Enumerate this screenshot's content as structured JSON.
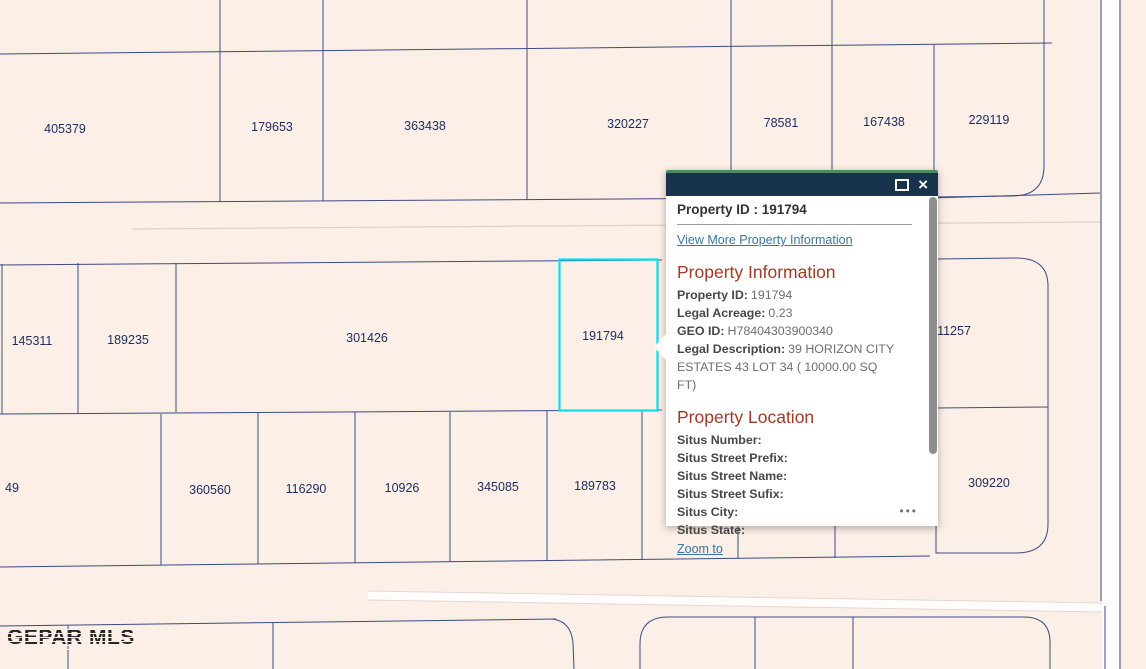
{
  "app": {
    "watermark": "GEPAR MLS"
  },
  "map": {
    "background_color": "#fbefe8",
    "parcel_line_color": "#3d4c80",
    "parcel_label_color": "#1e2c5c",
    "highlight_color": "#06dff1",
    "road_color": "#fffdfb",
    "parcels": [
      "405379",
      "179653",
      "363438",
      "320227",
      "78581",
      "167438",
      "229119",
      "145311",
      "189235",
      "301426",
      "191794",
      "11257",
      "49",
      "360560",
      "116290",
      "10926",
      "345085",
      "189783",
      "309220"
    ],
    "highlighted_parcel": "191794"
  },
  "popup": {
    "title": "Property ID : 191794",
    "view_more_link": "View More Property Information",
    "info_heading": "Property Information",
    "info_rows": [
      {
        "label": "Property ID:",
        "value": "191794"
      },
      {
        "label": "Legal Acreage:",
        "value": "0.23"
      },
      {
        "label": "GEO ID:",
        "value": "H78404303900340"
      },
      {
        "label": "Legal Description:",
        "value": "39 HORIZON CITY ESTATES 43 LOT 34 ( 10000.00 SQ FT)"
      }
    ],
    "location_heading": "Property Location",
    "location_rows": [
      {
        "label": "Situs Number:",
        "value": ""
      },
      {
        "label": "Situs Street Prefix:",
        "value": ""
      },
      {
        "label": "Situs Street Name:",
        "value": ""
      },
      {
        "label": "Situs Street Sufix:",
        "value": ""
      },
      {
        "label": "Situs City:",
        "value": ""
      },
      {
        "label": "Situs State:",
        "value": ""
      }
    ],
    "zoom_to_link": "Zoom to",
    "icons": {
      "maximize": "square-outline",
      "close": "×",
      "more_options": "•••"
    },
    "header_color": "#17344c",
    "header_accent_color": "#4d8a68",
    "heading_color": "#a23a24",
    "link_color": "#3a75a1"
  }
}
